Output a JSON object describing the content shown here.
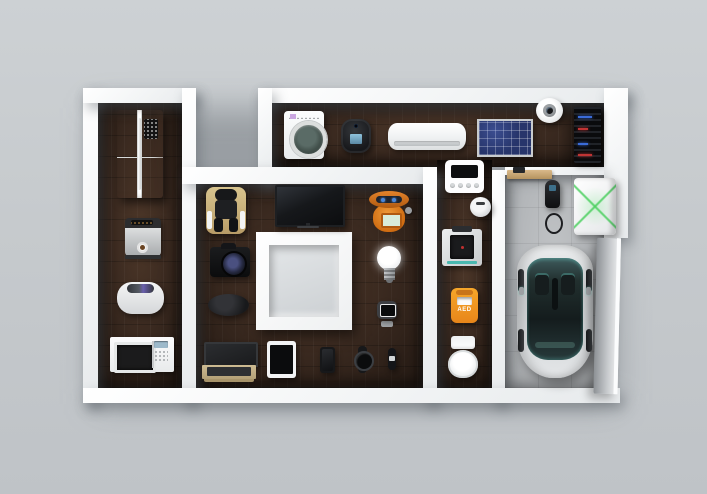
{
  "scene": {
    "type": "3d-render",
    "description": "Top view of a smart home floor plan concept: white cutaway walls, dark wood floors and a concrete garage, populated with smart / IoT appliances",
    "background_color": "#c6cacd",
    "wall_color": "#f4f6f7",
    "wood_floor_color": "#3b2a20",
    "garage_floor_color": "#b3b6b9"
  },
  "labels": {
    "aed": "AED"
  },
  "accent_colors": {
    "aed_orange": "#f09020",
    "robot_orange": "#d9731c",
    "solar_panel_blue": "#27356b",
    "car_teal": "#5fc4b8",
    "battery_green": "#4cd060",
    "massage_chair_tan": "#c9b178"
  },
  "rooms": [
    {
      "name": "kitchen",
      "devices": [
        "smart-refrigerator",
        "coffee-machine",
        "rice-cooker",
        "microwave-oven"
      ]
    },
    {
      "name": "utility-room",
      "devices": [
        "washing-machine",
        "smart-home-hub",
        "air-conditioner",
        "solar-panel",
        "dome-security-camera",
        "server-rack"
      ]
    },
    {
      "name": "living-room",
      "devices": [
        "massage-chair",
        "flat-screen-tv",
        "home-robot",
        "dslr-camera",
        "led-bulb",
        "computer-mouse",
        "smart-camera",
        "laptop",
        "tablet",
        "smartphone",
        "smartwatch",
        "fitness-tracker"
      ],
      "feature": "central-atrium-block"
    },
    {
      "name": "corridor-bathroom",
      "devices": [
        "energy-monitor-panel",
        "smart-thermostat",
        "3d-printer",
        "aed-defibrillator",
        "smart-toilet"
      ]
    },
    {
      "name": "garage",
      "devices": [
        "wall-shelf",
        "ev-charger",
        "home-battery-unit",
        "electric-car",
        "garage-door"
      ]
    }
  ]
}
